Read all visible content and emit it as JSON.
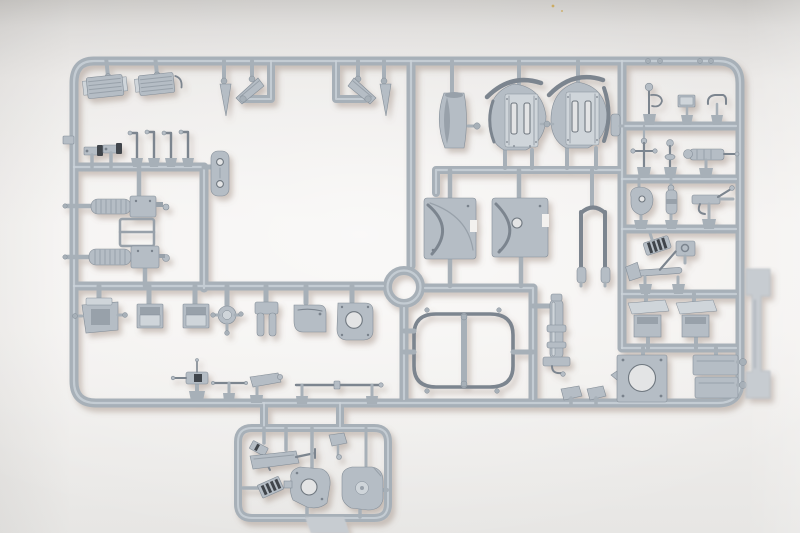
{
  "scene": {
    "description": "Photograph of a light grey injection-moulded plastic model kit sprue (runner frame full of unassembled parts) lying on a pale grey studio background, soft shadow falling down-right",
    "text_visible": "none",
    "sprue_shape": "large rounded-rectangle runner frame with internal runner rails, a central circular runner ring, a small rounded sub-frame loop at bottom centre, and a blank out-of-focus moulding tag on the right edge"
  },
  "colors": {
    "background_top": "#c8c6c3",
    "background_upper": "#e9e7e5",
    "background_center": "#f3f1ef",
    "background_bottom": "#e7e6e4",
    "runner": "#a7b0b8",
    "runner_highlight": "#ccd3d9",
    "part": "#b5bdc5",
    "part_highlight": "#cfd5da",
    "part_shade": "#98a1aa",
    "part_line": "#848e98",
    "dark_detail": "#41454b",
    "hole": "#e3e4e5",
    "tag": "#c7ccd1",
    "speck": "#c9a24a",
    "cast_shadow": "#8a7468"
  },
  "parts_manifest": [
    {
      "name": "radiator-grille",
      "count": 2,
      "where": "top left, ribbed rectangular blocks"
    },
    {
      "name": "lever-arm",
      "count": 4,
      "where": "upper left, thin hooked levers"
    },
    {
      "name": "bolt-assembly",
      "count": 2,
      "where": "upper left, small parts with dark caps"
    },
    {
      "name": "detail-panel",
      "count": 1,
      "where": "left, rounded panel with two holes"
    },
    {
      "name": "engine-muffler",
      "count": 2,
      "where": "left, ribbed cylinders with end boxes"
    },
    {
      "name": "mount-frame",
      "count": 1,
      "where": "left, thin rectangular frame between mufflers"
    },
    {
      "name": "spade-bracket-assembly",
      "count": 2,
      "where": "top centre, mirrored spike and gusset pairs"
    },
    {
      "name": "stowage-box",
      "count": 2,
      "where": "middle row, open square boxes"
    },
    {
      "name": "stowage-bracket",
      "count": 1,
      "where": "middle row left, winged open box"
    },
    {
      "name": "idler-hub",
      "count": 1,
      "where": "middle row, disc with three pins"
    },
    {
      "name": "u-bracket",
      "count": 1,
      "where": "middle row, two-pronged bracket"
    },
    {
      "name": "rounded-box",
      "count": 1,
      "where": "middle row, rounded-corner box"
    },
    {
      "name": "fan-housing",
      "count": 1,
      "where": "middle row, housing with circular hole"
    },
    {
      "name": "mg-mount",
      "count": 1,
      "where": "lower left, small gun with dark receiver"
    },
    {
      "name": "tie-rod",
      "count": 1,
      "where": "lower left, thin T-rod"
    },
    {
      "name": "support-bracket",
      "count": 1,
      "where": "lower left, angled plate"
    },
    {
      "name": "gun-barrel",
      "count": 1,
      "where": "bottom, long thin rod"
    },
    {
      "name": "hatch-ring",
      "count": 1,
      "where": "centre, circular runner ring"
    },
    {
      "name": "turret-race-ring",
      "count": 1,
      "where": "centre, oval ring with centre bar"
    },
    {
      "name": "jack",
      "count": 1,
      "where": "centre right, vertical cylinder with base plate"
    },
    {
      "name": "curved-duct",
      "count": 1,
      "where": "top centre, curved hollow box"
    },
    {
      "name": "gun-shield",
      "count": 2,
      "where": "top centre, round shields with twin slots and rivets"
    },
    {
      "name": "shield-arc",
      "count": 2,
      "where": "darker curved strips above each shield"
    },
    {
      "name": "gun-cradle-plate",
      "count": 2,
      "where": "centre, square plates with S-curved groove"
    },
    {
      "name": "tow-frame",
      "count": 1,
      "where": "centre, U-shaped frame with cylinder feet"
    },
    {
      "name": "periscope-figure",
      "count": 1,
      "where": "right grid row 1"
    },
    {
      "name": "stowage-lid",
      "count": 1,
      "where": "right grid row 1"
    },
    {
      "name": "clamp",
      "count": 1,
      "where": "right grid row 1"
    },
    {
      "name": "cross-lever",
      "count": 1,
      "where": "right grid row 2"
    },
    {
      "name": "shift-lever",
      "count": 1,
      "where": "right grid row 2"
    },
    {
      "name": "finned-breech",
      "count": 1,
      "where": "right grid row 2"
    },
    {
      "name": "pivot-block",
      "count": 1,
      "where": "right grid row 3"
    },
    {
      "name": "cylinder-mount",
      "count": 1,
      "where": "right grid row 3"
    },
    {
      "name": "mg-bracket",
      "count": 1,
      "where": "right grid row 3"
    },
    {
      "name": "track-link",
      "count": 1,
      "where": "right grid row 4, dark striped"
    },
    {
      "name": "latch-box",
      "count": 1,
      "where": "right grid row 4"
    },
    {
      "name": "pick-axe",
      "count": 1,
      "where": "right grid row 4"
    },
    {
      "name": "hull-plate-box",
      "count": 2,
      "where": "right grid row 5, angled plate over open box"
    },
    {
      "name": "turret-base-plate",
      "count": 1,
      "where": "bottom right, square plate with large round hole"
    },
    {
      "name": "stacked-boxes",
      "count": 1,
      "where": "bottom right, two rectangular boxes"
    },
    {
      "name": "moulding-tag",
      "count": 1,
      "where": "right edge, blank blurred tag"
    },
    {
      "name": "shovel",
      "count": 1,
      "where": "bottom sub-frame"
    },
    {
      "name": "pick",
      "count": 1,
      "where": "bottom sub-frame"
    },
    {
      "name": "track-pad",
      "count": 1,
      "where": "bottom sub-frame, dark striped"
    },
    {
      "name": "housing-with-hole",
      "count": 1,
      "where": "bottom sub-frame"
    },
    {
      "name": "housing-with-boss",
      "count": 1,
      "where": "bottom sub-frame"
    },
    {
      "name": "moulding-tab",
      "count": 1,
      "where": "below sub-frame at image bottom edge"
    }
  ]
}
